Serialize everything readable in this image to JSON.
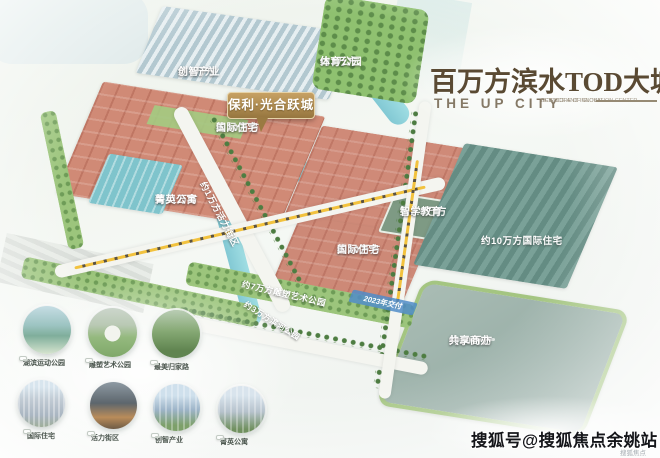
{
  "header": {
    "title_cn": "百万方滨水TOD大城",
    "title_en": "THE UP CITY",
    "caption_line1": "NEW CORE OF GLOBAL",
    "caption_line2": "SCIENCE AND INNOVATION CENTER"
  },
  "project_badge": {
    "name": "保利·光合跃城"
  },
  "map": {
    "labels": [
      {
        "id": "sports-park",
        "line1": "约3万方",
        "line2": "体育公园"
      },
      {
        "id": "innovation-industry",
        "line1": "约4万方",
        "line2": "创智产业"
      },
      {
        "id": "intl-residence-1",
        "line1": "约20万方",
        "line2": "国际住宅"
      },
      {
        "id": "elite-apartments",
        "line1": "约11万方",
        "line2": "菁英公寓"
      },
      {
        "id": "smart-education",
        "line1": "约2.5万方",
        "line2": "智学教育"
      },
      {
        "id": "intl-residence-2",
        "line1": "约20万方",
        "line2": "国际住宅"
      },
      {
        "id": "intl-residence-3",
        "line1": "约10万方国际住宅",
        "line2": ""
      },
      {
        "id": "shared-office",
        "line1": "约20万方",
        "line2": "共享商办"
      },
      {
        "id": "vitality-street",
        "line1": "约1万方活力街区",
        "line2": ""
      },
      {
        "id": "sculpture-art-park",
        "line1": "约7万方雕塑艺术公园",
        "line2": ""
      },
      {
        "id": "riverside-park",
        "line1": "约3万方滨河公园",
        "line2": ""
      }
    ],
    "delivery_badge": "2023年交付"
  },
  "thumbnails": {
    "row1": [
      {
        "label": "湖滨运动公园"
      },
      {
        "label": "雕塑艺术公园"
      },
      {
        "label": "最美归家路"
      }
    ],
    "row2": [
      {
        "label": "国际住宅"
      },
      {
        "label": "活力街区"
      },
      {
        "label": "创智产业"
      },
      {
        "label": "菁英公寓"
      }
    ]
  },
  "watermark": {
    "main": "搜狐号@搜狐焦点余姚站",
    "corner": "搜狐焦点"
  },
  "colors": {
    "badge_gold": "#a8874f",
    "residential_salmon": "#cf8a78",
    "industry_teal": "#6f958c",
    "river_blue": "#8fd0d8",
    "park_green": "#96c178",
    "title_brown": "#5a4a33",
    "delivery_blue": "#508cc8"
  }
}
